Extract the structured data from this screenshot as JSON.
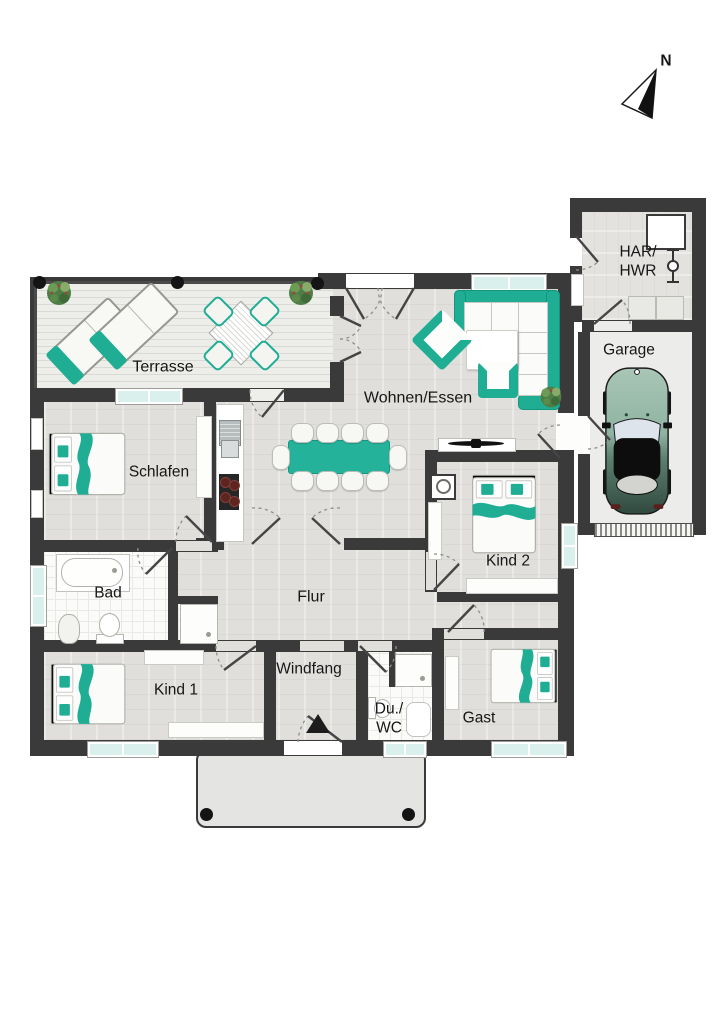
{
  "compass": {
    "north_label": "N"
  },
  "rooms": {
    "terrasse": "Terrasse",
    "wohnen_essen": "Wohnen/Essen",
    "schlafen": "Schlafen",
    "bad": "Bad",
    "flur": "Flur",
    "kind1": "Kind 1",
    "kind2": "Kind 2",
    "windfang": "Windfang",
    "du_wc_line1": "Du./",
    "du_wc_line2": "WC",
    "gast": "Gast",
    "garage": "Garage",
    "har_line1": "HAR/",
    "har_line2": "HWR"
  },
  "colors": {
    "wall": "#3a3a3a",
    "accent_teal": "#1fae94",
    "window_glass": "#d9f0ed",
    "wood_floor": "#e0dfdc",
    "deck": "#ebebe8",
    "tile": "#fbfbfa",
    "car_body_light": "#a9c6b6",
    "car_body_dark": "#3d5a4e"
  }
}
